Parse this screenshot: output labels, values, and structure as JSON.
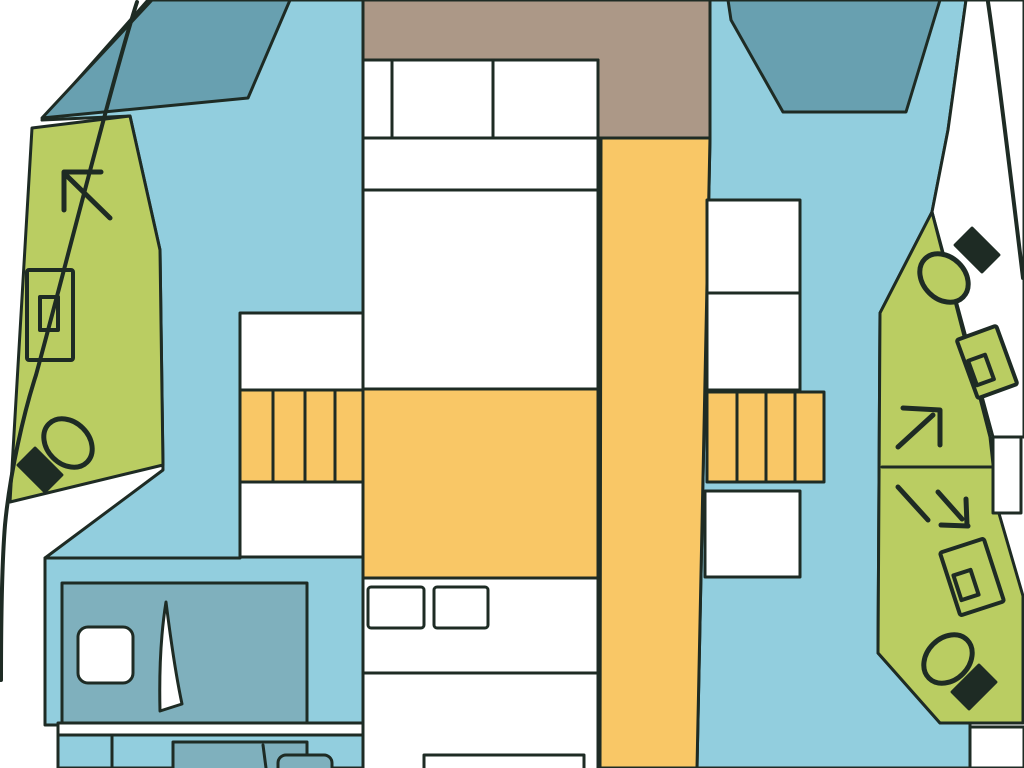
{
  "canvas": {
    "width": 1024,
    "height": 768,
    "bg": "#ffffff",
    "stroke_width": 3
  },
  "palette": {
    "outline": "#1e2b24",
    "light_blue": "#92cede",
    "teal_deck": "#68a0b0",
    "teal_bed": "#7fb0bd",
    "green": "#bacd62",
    "orange": "#f9c766",
    "brown": "#ac9887",
    "white": "#ffffff"
  },
  "shapes": [
    {
      "name": "port-interior-floor",
      "kind": "polygon",
      "fill": "$light_blue",
      "stroke": "$outline",
      "attrs": {
        "points": "148,0 363,0 363,768 58,768 58,725 45,725 45,558 163,470 160,250 130,116 42,120"
      }
    },
    {
      "name": "starboard-interior-floor",
      "kind": "polygon",
      "fill": "$light_blue",
      "stroke": "$outline",
      "attrs": {
        "points": "710,0 966,0 948,130 932,212 880,313 878,653 940,723 970,723 970,768 697,768 710,138"
      }
    },
    {
      "name": "starboard-side-deck",
      "kind": "polygon",
      "fill": "$white",
      "stroke": "$outline",
      "attrs": {
        "points": "966,0 1024,0 1024,437 993,437 932,212 948,130"
      }
    },
    {
      "name": "port-foredeck-seat",
      "kind": "polygon",
      "fill": "$teal_deck",
      "stroke": "$outline",
      "attrs": {
        "points": "152,0 290,0 278,28 248,98 42,118"
      }
    },
    {
      "name": "starboard-foredeck-seat",
      "kind": "polygon",
      "fill": "$teal_deck",
      "stroke": "$outline",
      "attrs": {
        "points": "728,0 940,0 906,112 783,112 731,20"
      }
    },
    {
      "name": "aft-deck",
      "kind": "polygon",
      "fill": "$brown",
      "stroke": "$outline",
      "attrs": {
        "points": "363,0 710,0 710,138 598,138 598,60 363,60"
      }
    },
    {
      "name": "port-bathroom-floor",
      "kind": "polygon",
      "fill": "$green",
      "stroke": "$outline",
      "attrs": {
        "points": "32,128 130,116 160,250 163,465 10,502"
      }
    },
    {
      "name": "starboard-bathroom-floor",
      "kind": "polygon",
      "fill": "$green",
      "stroke": "$outline",
      "attrs": {
        "points": "880,313 932,212 990,437 998,510 1023,596 1023,723 940,723 878,653"
      }
    },
    {
      "name": "corridor-floor",
      "kind": "polygon",
      "fill": "$orange",
      "stroke": "$outline",
      "attrs": {
        "points": "601,138 710,138 697,768 600,768"
      }
    },
    {
      "name": "saloon-floor",
      "kind": "rect",
      "fill": "$orange",
      "stroke": "$outline",
      "attrs": {
        "x": 363,
        "y": 389,
        "width": 235,
        "height": 189
      }
    },
    {
      "name": "port-stairs",
      "kind": "rect",
      "fill": "$orange",
      "stroke": "$outline",
      "attrs": {
        "x": 240,
        "y": 390,
        "width": 123,
        "height": 92
      }
    },
    {
      "name": "port-stairs-treads",
      "kind": "path",
      "stroke": "$outline",
      "attrs": {
        "d": "M273,390 V482 M305,390 V482 M335,390 V482"
      }
    },
    {
      "name": "starboard-stairs",
      "kind": "rect",
      "fill": "$orange",
      "stroke": "$outline",
      "attrs": {
        "x": 707,
        "y": 392,
        "width": 117,
        "height": 90
      }
    },
    {
      "name": "starboard-stairs-treads",
      "kind": "path",
      "stroke": "$outline",
      "attrs": {
        "d": "M737,392 V482 M766,392 V482 M795,392 V482"
      }
    },
    {
      "name": "port-landing-upper",
      "kind": "rect",
      "fill": "$white",
      "stroke": "$outline",
      "attrs": {
        "x": 240,
        "y": 313,
        "width": 123,
        "height": 77
      }
    },
    {
      "name": "port-landing-lower",
      "kind": "rect",
      "fill": "$white",
      "stroke": "$outline",
      "attrs": {
        "x": 240,
        "y": 482,
        "width": 123,
        "height": 75
      }
    },
    {
      "name": "starboard-locker-upper",
      "kind": "rect",
      "fill": "$white",
      "stroke": "$outline",
      "attrs": {
        "x": 707,
        "y": 200,
        "width": 93,
        "height": 93
      }
    },
    {
      "name": "starboard-locker-lower",
      "kind": "rect",
      "fill": "$white",
      "stroke": "$outline",
      "attrs": {
        "x": 707,
        "y": 293,
        "width": 93,
        "height": 97
      }
    },
    {
      "name": "starboard-landing-lower",
      "kind": "rect",
      "fill": "$white",
      "stroke": "$outline",
      "attrs": {
        "x": 705,
        "y": 491,
        "width": 95,
        "height": 86
      }
    },
    {
      "name": "owner-bed",
      "kind": "rect",
      "fill": "$white",
      "stroke": "$outline",
      "attrs": {
        "x": 363,
        "y": 60,
        "width": 235,
        "height": 329
      }
    },
    {
      "name": "owner-bed-pillow-lines",
      "kind": "path",
      "stroke": "$outline",
      "attrs": {
        "d": "M392,60 V138 M493,60 V138 M363,138 H598 M363,190 H598"
      }
    },
    {
      "name": "guest-bed",
      "kind": "rect",
      "fill": "$white",
      "stroke": "$outline",
      "attrs": {
        "x": 363,
        "y": 578,
        "width": 235,
        "height": 192
      }
    },
    {
      "name": "guest-bed-pillow-left",
      "kind": "rect",
      "fill": "$white",
      "stroke": "$outline",
      "attrs": {
        "x": 368,
        "y": 587,
        "width": 56,
        "height": 41,
        "rx": 3
      }
    },
    {
      "name": "guest-bed-pillow-right",
      "kind": "rect",
      "fill": "$white",
      "stroke": "$outline",
      "attrs": {
        "x": 434,
        "y": 587,
        "width": 54,
        "height": 41,
        "rx": 3
      }
    },
    {
      "name": "guest-bed-fold-line",
      "kind": "path",
      "stroke": "$outline",
      "attrs": {
        "d": "M363,673 H598"
      }
    },
    {
      "name": "guest-bed-footboard",
      "kind": "rect",
      "fill": "$white",
      "stroke": "$outline",
      "attrs": {
        "x": 424,
        "y": 755,
        "width": 160,
        "height": 18
      }
    },
    {
      "name": "port-cabin-bed",
      "kind": "rect",
      "fill": "$teal_bed",
      "stroke": "$outline",
      "attrs": {
        "x": 62,
        "y": 583,
        "width": 245,
        "height": 140
      }
    },
    {
      "name": "port-cabin-pillow",
      "kind": "rect",
      "fill": "$white",
      "stroke": "$outline",
      "attrs": {
        "x": 78,
        "y": 627,
        "width": 55,
        "height": 56,
        "rx": 10
      }
    },
    {
      "name": "port-cabin-door",
      "kind": "path",
      "fill": "$white",
      "stroke": "$outline",
      "attrs": {
        "d": "M166,602 C171,642 176,676 182,704 L160,711 C159,669 161,633 166,602 Z"
      }
    },
    {
      "name": "port-bulkhead",
      "kind": "rect",
      "fill": "$white",
      "stroke": "$outline",
      "attrs": {
        "x": 58,
        "y": 723,
        "width": 305,
        "height": 12
      }
    },
    {
      "name": "port-closet-divider",
      "kind": "path",
      "stroke": "$outline",
      "attrs": {
        "d": "M112,735 V768"
      }
    },
    {
      "name": "port-aft-cabin-bed",
      "kind": "rect",
      "fill": "$teal_bed",
      "stroke": "$outline",
      "attrs": {
        "x": 173,
        "y": 742,
        "width": 134,
        "height": 30
      }
    },
    {
      "name": "port-aft-cabin-pillow",
      "kind": "rect",
      "fill": "$teal_bed",
      "stroke": "$outline",
      "attrs": {
        "x": 278,
        "y": 755,
        "width": 54,
        "height": 26,
        "rx": 8
      }
    },
    {
      "name": "port-aft-cabin-door",
      "kind": "path",
      "stroke": "$outline",
      "attrs": {
        "d": "M263,745 C264,753 265,760 266,768"
      }
    },
    {
      "name": "port-step-line",
      "kind": "path",
      "stroke": "$outline",
      "attrs": {
        "d": "M45,558 H240"
      }
    },
    {
      "name": "port-shower-arrow-icon",
      "kind": "path",
      "stroke": "$outline",
      "sw": 5,
      "attrs": {
        "d": "M110,218 L67,176 M64,172 L101,172 M64,172 L64,210"
      }
    },
    {
      "name": "port-sink-icon",
      "kind": "rect",
      "fill": "$green",
      "stroke": "$outline",
      "sw": 4,
      "attrs": {
        "x": 27,
        "y": 270,
        "width": 46,
        "height": 90,
        "rx": 2
      }
    },
    {
      "name": "port-sink-basin-icon",
      "kind": "rect",
      "fill": "$green",
      "stroke": "$outline",
      "sw": 4,
      "attrs": {
        "x": 40,
        "y": 297,
        "width": 18,
        "height": 33
      }
    },
    {
      "name": "port-toilet-bowl-icon",
      "kind": "ellipse",
      "fill": "$green",
      "stroke": "$outline",
      "sw": 5,
      "attrs": {
        "cx": 68,
        "cy": 443,
        "rx": 27,
        "ry": 21
      },
      "transform": "rotate(45,68,443)"
    },
    {
      "name": "port-toilet-tank-icon",
      "kind": "rect",
      "fill": "$outline",
      "stroke": "$outline",
      "attrs": {
        "x": 21,
        "y": 458,
        "width": 38,
        "height": 24
      },
      "transform": "rotate(45,40,470)"
    },
    {
      "name": "starboard-toilet-upper-bowl-icon",
      "kind": "ellipse",
      "fill": "$green",
      "stroke": "$outline",
      "sw": 5,
      "attrs": {
        "cx": 944,
        "cy": 278,
        "rx": 27,
        "ry": 21
      },
      "transform": "rotate(45,944,278)"
    },
    {
      "name": "starboard-toilet-upper-tank-icon",
      "kind": "rect",
      "fill": "$outline",
      "stroke": "$outline",
      "attrs": {
        "x": 958,
        "y": 238,
        "width": 38,
        "height": 24
      },
      "transform": "rotate(45,977,250)"
    },
    {
      "name": "starboard-sink-upper-icon",
      "kind": "rect",
      "fill": "$green",
      "stroke": "$outline",
      "sw": 4,
      "attrs": {
        "x": 966,
        "y": 331,
        "width": 42,
        "height": 62,
        "rx": 2
      },
      "transform": "rotate(-20,987,362)"
    },
    {
      "name": "starboard-sink-upper-basin-icon",
      "kind": "rect",
      "fill": "$green",
      "stroke": "$outline",
      "sw": 4,
      "attrs": {
        "x": 972,
        "y": 357,
        "width": 18,
        "height": 26
      },
      "transform": "rotate(-20,981,370)"
    },
    {
      "name": "starboard-shower-arrow-upper-icon",
      "kind": "path",
      "stroke": "$outline",
      "sw": 5,
      "attrs": {
        "d": "M898,447 L933,415 M903,408 L940,410 M940,410 L940,445"
      }
    },
    {
      "name": "starboard-bathroom-divider",
      "kind": "path",
      "stroke": "$outline",
      "attrs": {
        "d": "M882,467 H993"
      }
    },
    {
      "name": "starboard-window",
      "kind": "rect",
      "fill": "$white",
      "stroke": "$outline",
      "attrs": {
        "x": 993,
        "y": 437,
        "width": 28,
        "height": 76
      }
    },
    {
      "name": "starboard-shower-arrow-lower-icon",
      "kind": "path",
      "stroke": "$outline",
      "sw": 5,
      "attrs": {
        "d": "M898,487 L928,520 M938,492 L962,519 M941,525 L968,526 M966,499 L967,525"
      }
    },
    {
      "name": "starboard-sink-lower-icon",
      "kind": "rect",
      "fill": "$green",
      "stroke": "$outline",
      "sw": 4,
      "attrs": {
        "x": 949,
        "y": 544,
        "width": 46,
        "height": 66,
        "rx": 2
      },
      "transform": "rotate(-18,972,577)"
    },
    {
      "name": "starboard-sink-lower-basin-icon",
      "kind": "rect",
      "fill": "$green",
      "stroke": "$outline",
      "sw": 4,
      "attrs": {
        "x": 957,
        "y": 572,
        "width": 18,
        "height": 26
      },
      "transform": "rotate(-18,966,585)"
    },
    {
      "name": "starboard-toilet-lower-bowl-icon",
      "kind": "ellipse",
      "fill": "$green",
      "stroke": "$outline",
      "sw": 5,
      "attrs": {
        "cx": 948,
        "cy": 659,
        "rx": 27,
        "ry": 21
      },
      "transform": "rotate(-45,948,659)"
    },
    {
      "name": "starboard-toilet-lower-tank-icon",
      "kind": "rect",
      "fill": "$outline",
      "stroke": "$outline",
      "attrs": {
        "x": 955,
        "y": 675,
        "width": 38,
        "height": 24
      },
      "transform": "rotate(-45,974,687)"
    },
    {
      "name": "starboard-stern-locker",
      "kind": "rect",
      "fill": "$white",
      "stroke": "$outline",
      "attrs": {
        "x": 970,
        "y": 727,
        "width": 54,
        "height": 41
      }
    },
    {
      "name": "port-hull-line",
      "kind": "path",
      "stroke": "$outline",
      "sw": 4,
      "attrs": {
        "d": "M137,2 C115,70 62,280 36,375 C24,412 10,472 5,525 C2,562 1,620 1,680"
      }
    },
    {
      "name": "starboard-hull-line",
      "kind": "path",
      "stroke": "$outline",
      "sw": 4,
      "attrs": {
        "d": "M988,2 C998,70 1010,170 1023,278"
      }
    }
  ]
}
